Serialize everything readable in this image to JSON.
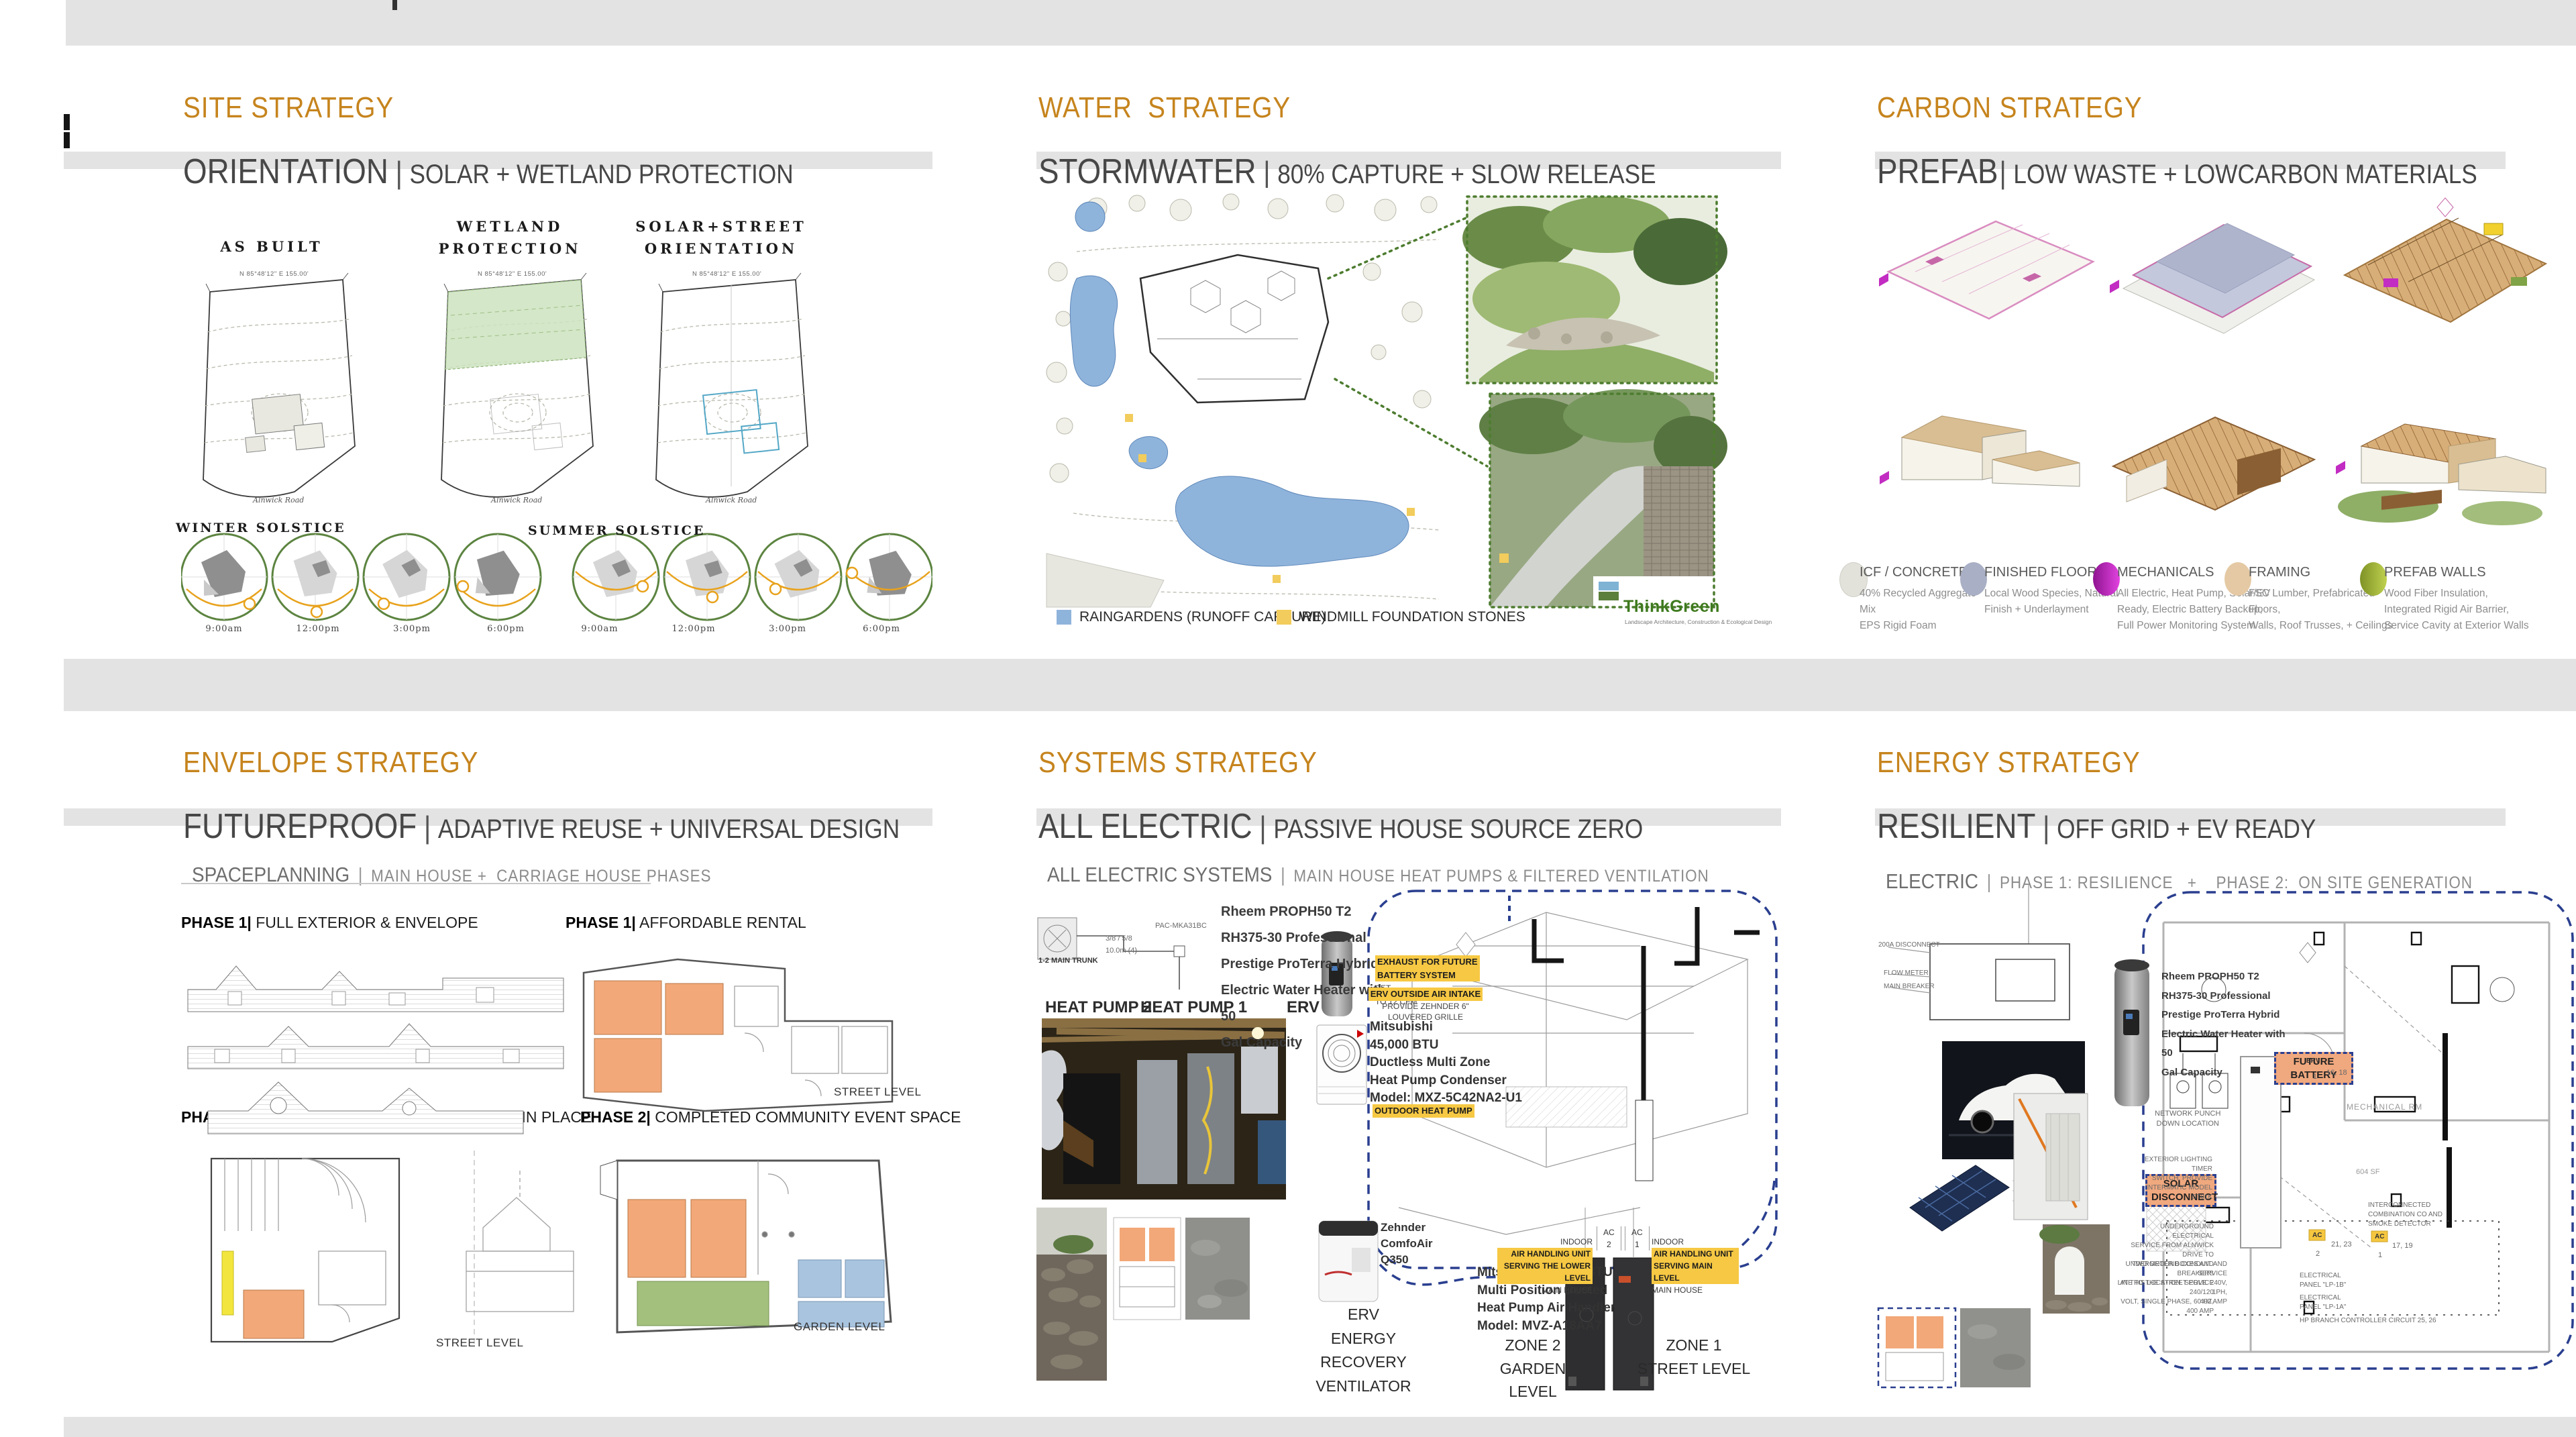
{
  "colors": {
    "accent_orange": "#C6841D",
    "header_gray": "#474747",
    "band_gray": "#E3E3E3",
    "navy_dashed": "#2A3F8F",
    "highlight_yellow": "#F6C843",
    "tag_orange": "#F0A87E",
    "legend_blue": "#8FB4DC",
    "legend_yellow": "#F2CC5C",
    "solstice_green": "#5C8440",
    "sun_orange": "#E8A21C"
  },
  "panels": [
    {
      "title": "SITE STRATEGY",
      "lead": "ORIENTATION",
      "sep": "|",
      "sub": "SOLAR + WETLAND PROTECTION"
    },
    {
      "title": "WATER  STRATEGY",
      "lead": "STORMWATER",
      "sep": "|",
      "sub": "80% CAPTURE + SLOW RELEASE"
    },
    {
      "title": "CARBON STRATEGY",
      "lead": "PREFAB",
      "sep": "|",
      "sub": "LOW WASTE + LOWCARBON MATERIALS"
    },
    {
      "title": "ENVELOPE STRATEGY",
      "lead": "FUTUREPROOF",
      "sep": "|",
      "sub": "ADAPTIVE REUSE + UNIVERSAL DESIGN"
    },
    {
      "title": "SYSTEMS STRATEGY",
      "lead": "ALL ELECTRIC",
      "sep": "|",
      "sub": "PASSIVE HOUSE SOURCE ZERO"
    },
    {
      "title": "ENERGY STRATEGY",
      "lead": "RESILIENT",
      "sep": "|",
      "sub": "OFF GRID + EV READY"
    }
  ],
  "site": {
    "plan_labels": [
      "AS BUILT",
      "WETLAND\nPROTECTION",
      "SOLAR+STREET\nORIENTATION"
    ],
    "dim": "N 85°48'12\" E  155.00'",
    "road": "Alnwick Road",
    "winter": "WINTER SOLSTICE",
    "summer": "SUMMER SOLSTICE",
    "times": [
      "9:00am",
      "12:00pm",
      "3:00pm",
      "6:00pm",
      "9:00am",
      "12:00pm",
      "3:00pm",
      "6:00pm"
    ]
  },
  "water": {
    "legend": [
      {
        "label": "RAINGARDENS (RUNOFF CAPTURE)",
        "color": "#8FB4DC"
      },
      {
        "label": "WINDMILL FOUNDATION STONES",
        "color": "#F2CC5C"
      }
    ],
    "logo": "ThinkGreen",
    "logo_tagline": "Landscape Architecture, Construction & Ecological Design"
  },
  "carbon": {
    "legend": [
      {
        "title": "ICF / CONCRETE",
        "desc": "40% Recycled Aggregate  Mix\nEPS Rigid Foam",
        "color": "#DCDCD4"
      },
      {
        "title": "FINISHED FLOORS",
        "desc": "Local Wood Species, Natural\nFinish + Underlayment",
        "color": "#A9AFC4"
      },
      {
        "title": "MECHANICALS",
        "desc": "All Electric, Heat Pump, Solar/EV\nReady, Electric Battery Backup,\nFull Power Monitoring System",
        "color": "#C22CC2"
      },
      {
        "title": "FRAMING",
        "desc": "FSC Lumber, Prefabricated Floors,\nWalls, Roof Trusses, + Ceilings",
        "color": "#E4C9A4"
      },
      {
        "title": "PREFAB WALLS",
        "desc": "Wood Fiber Insulation,\nIntegrated Rigid Air Barrier,\nService Cavity at Exterior Walls",
        "color": "#9FB23B"
      }
    ]
  },
  "envelope": {
    "heading": "SPACEPLANNING",
    "heading_sep": "|",
    "heading_sub": "MAIN HOUSE +  CARRIAGE HOUSE PHASES",
    "phases": [
      {
        "bold": "PHASE 1|",
        "rest": " FULL EXTERIOR & ENVELOPE"
      },
      {
        "bold": "PHASE 1|",
        "rest": " AFFORDABLE RENTAL"
      },
      {
        "bold": "PHASE 2|",
        "rest": " 20 YEAR RENOVATION  FOR AGING IN PLACE"
      },
      {
        "bold": "PHASE 2|",
        "rest": " COMPLETED COMMUNITY EVENT SPACE"
      }
    ],
    "levels": {
      "street1": "STREET LEVEL",
      "street2": "STREET LEVEL",
      "garden": "GARDEN LEVEL"
    }
  },
  "systems": {
    "heading": "ALL ELECTRIC SYSTEMS",
    "heading_sep": "|",
    "heading_sub": "MAIN HOUSE HEAT PUMPS & FILTERED VENTILATION",
    "mini": {
      "model": "PAC-MKA31BC",
      "pipe": "3/8  /  5/8",
      "length": "10.0m (4)",
      "trunk": "1-2 MAIN TRUNK"
    },
    "rheem": "Rheem PROPH50 T2\nRH375-30 Professional\nPrestige ProTerra Hybrid\nElectric Water Heater with 50\nGal Capacity",
    "labels": {
      "hp2": "HEAT PUMP 2",
      "hp1": "HEAT PUMP 1",
      "erv": "ERV"
    },
    "exhaust_hl": "EXHAUST FOR FUTURE\nBATTERY SYSTEM",
    "exhaust_rest": "SET\nTO 12 CFM",
    "intake_hl": "ERV OUTSIDE AIR INTAKE",
    "intake_rest": "PROVIDE ZEHNDER 6\"\nLOUVERED GRILLE",
    "condenser": "Mitsubishi\n45,000 BTU\nDuctless Multi Zone\nHeat Pump Condenser\nModel: MXZ-5C42NA2-U1",
    "outdoor_hl": "OUTDOOR HEAT PUMP",
    "zehnder": "Zehnder\nComfoAir\nQ350",
    "erv_caption": "ERV\nENERGY\nRECOVERY\nVENTILATOR",
    "air_handler": "Mitsubishi 18,000 BTU\nMulti Position Ducted\nHeat Pump Air Handler\nModel: MVZ-A18AA7",
    "indoor2_pre": "INDOOR ",
    "indoor2_hl": "AIR HANDLING UNIT\nSERVING THE LOWER LEVEL",
    "indoor2_post": "MAIN HOUSE",
    "ac2": "AC\n2",
    "ac1": "AC\n1",
    "indoor1_pre": "INDOOR ",
    "indoor1_hl": "AIR HANDLING UNIT\nSERVING MAIN LEVEL",
    "indoor1_post": "MAIN HOUSE",
    "zone2": "ZONE 2\nGARDEN LEVEL",
    "zone1": "ZONE 1\nSTREET LEVEL"
  },
  "energy": {
    "heading": "ELECTRIC",
    "heading_sep": "|",
    "heading_sub": "PHASE 1: RESILIENCE   +    PHASE 2:  ON SITE GENERATION",
    "oneline": [
      "200A DISCONNECT",
      "FLOW METER",
      "MAIN BREAKER"
    ],
    "rheem": "Rheem PROPH50 T2\nRH375-30 Professional\nPrestige ProTerra Hybrid\nElectric Water Heater with 50\nGal Capacity",
    "future_battery": "FUTURE BATTERY",
    "solar_disconnect": "SOLAR\nDISCONNECT",
    "mech_rm": "MECHANICAL RM",
    "mech_sf": "604 SF",
    "erv_tag": "ERV",
    "erv_no": "1",
    "erv_ckts": "16, 18",
    "ac2_tag": "AC",
    "ac2_no": "2",
    "ac2_ckts": "21, 23",
    "ac1_tag": "AC",
    "ac1_no": "1",
    "ac1_ckts": "17, 19",
    "network_note": "NETWORK PUNCH\nDOWN LOCATION",
    "lighting_note": "EXTERIOR LIGHTING TIMER\nSWITCH, PROVIDE\nINTERMATIC MODEL ST01K",
    "co_note": "INTERCONNECTED\nCOMBINATION CO AND\nSMOKE DETECTOR",
    "panel_b": "ELECTRICAL\nPANEL \"LP-1B\"",
    "panel_a": "ELECTRICAL\nPANEL \"LP-1A\"",
    "hp_branch": "HP BRANCH CONTROLLER CIRCUIT 25, 26",
    "underground_service": "UNDERGROUND ELECTRICAL\nSERVICE FROM ALNWICK DRIVE TO\nTWO METER BOXES AND BREAKERS\nAT THIS LOCATION. SERVICE 240/120\nVOLT, SINGLE PHASE, 60 HZ, 400 AMP",
    "underground_conduit": "UNDERGROUND CONDUIT AND SERVICE\nLINE TO THE STREET POLE. 240V, 1PH,\n400 AMP"
  }
}
